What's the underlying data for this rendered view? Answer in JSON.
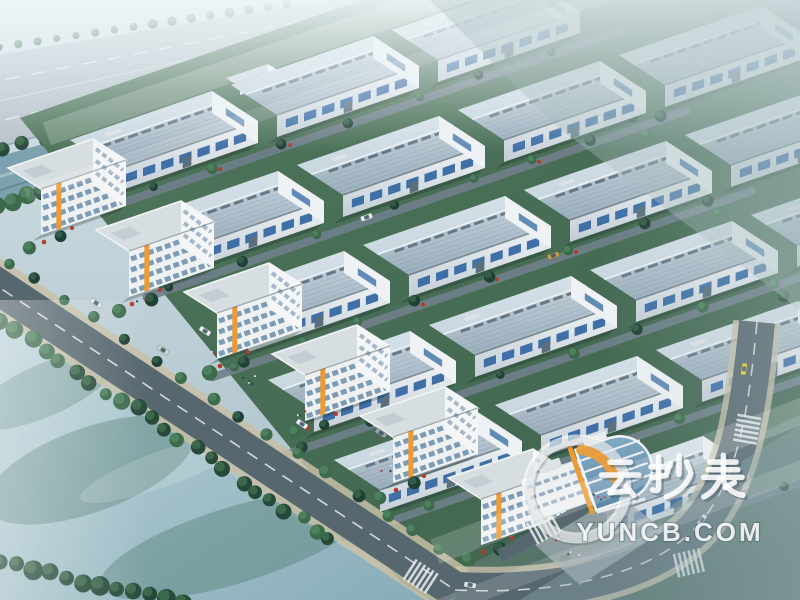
{
  "meta": {
    "description": "Aerial bird's-eye 3D architectural rendering of an industrial park: diagonal rows of grey-roofed factory workshops, white office buildings with orange accents along a tree-lined main road, a misty highway and canal at the upper left, farmland fading into haze at the upper right, and a wide river at the lower left.",
    "style": "photorealistic render, cool blue-grey misty tone"
  },
  "watermark": {
    "brand_cn": "云抄表",
    "brand_domain": "YUNCB.COM"
  },
  "palette": {
    "sky_top": "#d4e1e7",
    "sky_bottom": "#a9bfc8",
    "mist": "#eef5f8",
    "field_light": "#7d968a",
    "field_dark": "#37524b",
    "site_green_1": "#52795e",
    "site_green_2": "#3c5f4c",
    "grass_br_1": "#6d8a7e",
    "grass_br_2": "#4d6a60",
    "highway_grey": "#b6c1c7",
    "canal_blue": "#7ba2ae",
    "water_1": "#bed4da",
    "water_2": "#88acb8",
    "water_patch": "#4f7a70",
    "roof_1": "#cdd9e1",
    "roof_2": "#9cafbd",
    "roof_ridge": "#e9eff3",
    "skylight_grey": "#5d7180",
    "wall_1": "#eef2f4",
    "wall_2": "#c3ced5",
    "window_blue": "#3f6fa6",
    "office_wall": "#eef1f2",
    "office_floor_blue": "#7292b0",
    "accent_orange": "#ec9a33",
    "road_asphalt": "#57676f",
    "sidewalk_tan": "#c6bfa7",
    "lane_grey": "#70808a",
    "road_line_white": "#ffffff",
    "tree_dark": "#27493a",
    "tree_mid": "#3e6a4c",
    "tree_light": "#4f8360",
    "shrub_red": "#b23c2c",
    "plaza_grey": "#9fabb1",
    "glass_1": "#7fa9c4",
    "glass_2": "#5c87a6",
    "watermark_white": "#ffffff",
    "logo_orange": "#f09c32",
    "car_yellow": "#e8c93e"
  }
}
